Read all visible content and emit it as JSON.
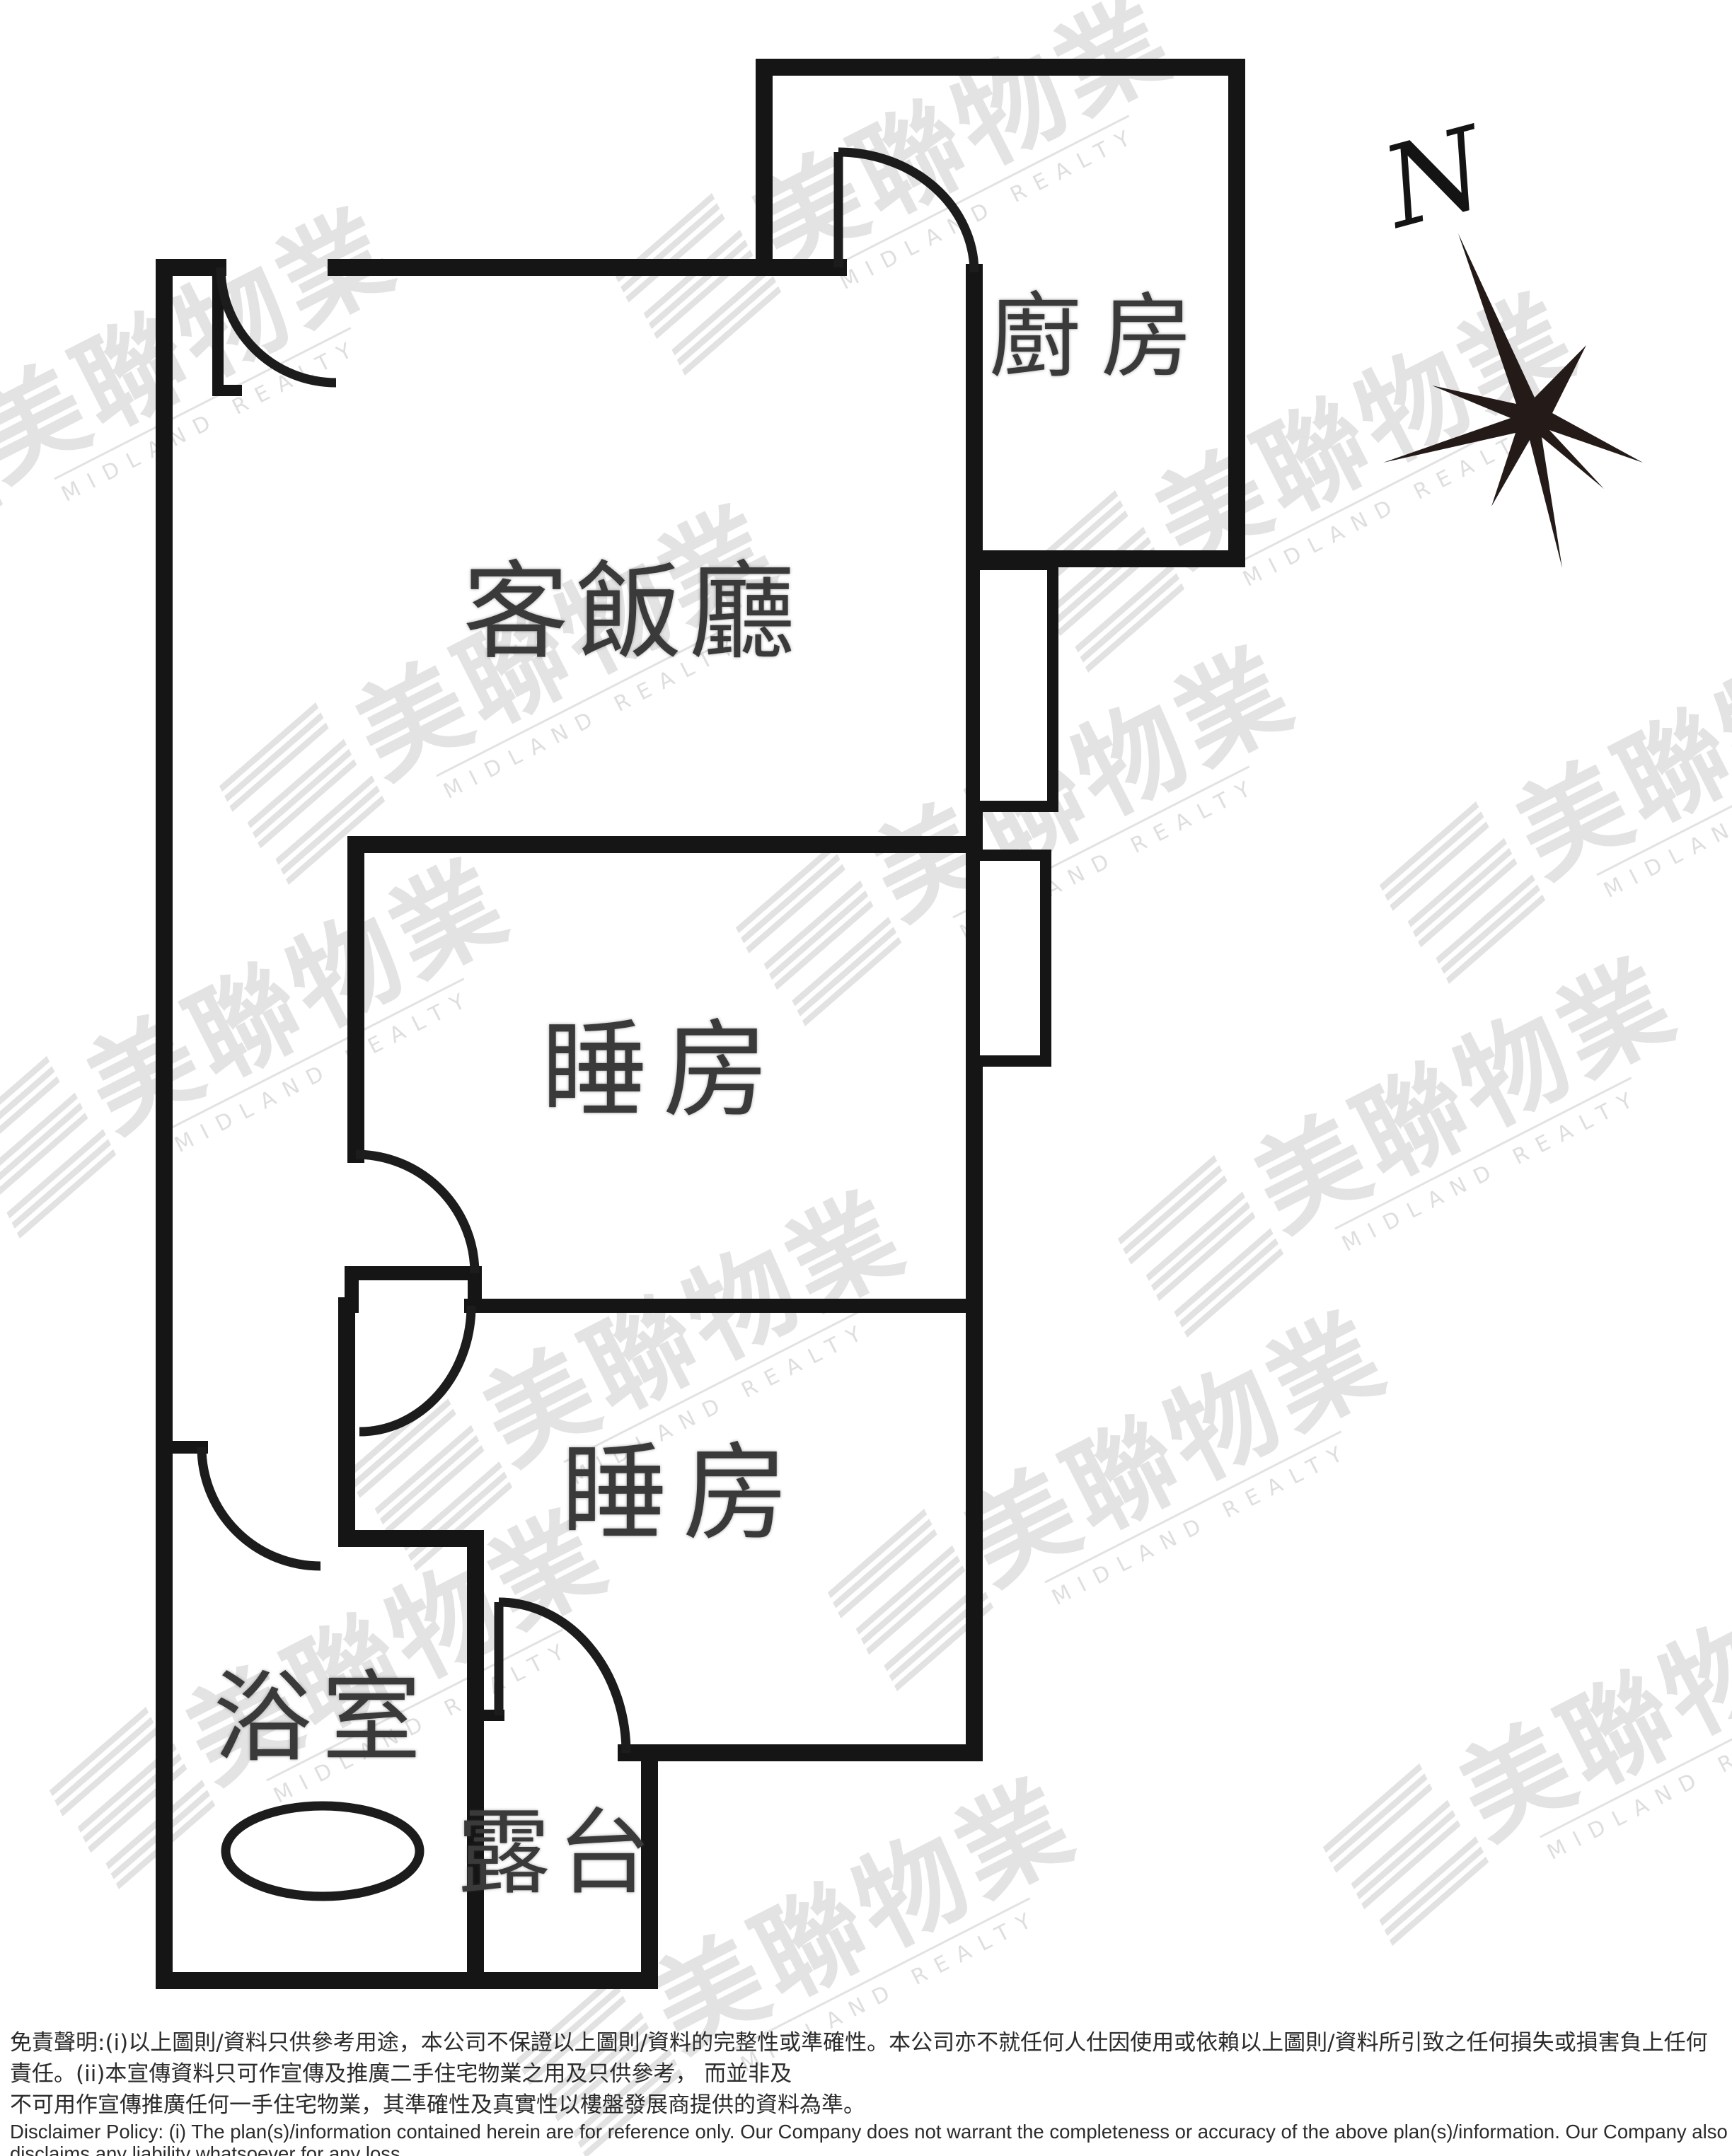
{
  "compass": {
    "north_label": "N"
  },
  "rooms": {
    "kitchen": "廚房",
    "living_dining": "客飯廳",
    "bedroom_upper": "睡房",
    "bedroom_lower": "睡房",
    "bathroom": "浴室",
    "balcony": "露台"
  },
  "watermark": {
    "cjk": "美聯物業",
    "latin": "MIDLAND REALTY"
  },
  "disclaimer": {
    "zh_line1": "免責聲明:(i)以上圖則/資料只供參考用途，本公司不保證以上圖則/資料的完整性或準確性。本公司亦不就任何人仕因使用或依賴以上圖則/資料所引致之任何損失或損害負上任何責任。(ii)本宣傳資料只可作宣傳及推廣二手住宅物業之用及只供參考， 而並非及",
    "zh_line2": "不可用作宣傳推廣任何一手住宅物業，其準確性及真實性以樓盤發展商提供的資料為準。",
    "en_line1": "Disclaimer Policy: (i) The plan(s)/information contained herein are for reference only. Our Company does not warrant the completeness or accuracy of the above plan(s)/information. Our Company also disclaims any liability whatsoever for any loss",
    "en_line2": "or damage suffered or to be suffered by any person as a result of using or relying on the plan(s)/information. (ii) This promotional material is for the purpose of promoting second-hand residential properties and for reference only. This",
    "en_line3": "promotional material shall not be used for the purpose of promoting first-hand residential properties. The accuracy and truth of the information contained in this promotional material shall be subject to information provided by the developers."
  }
}
